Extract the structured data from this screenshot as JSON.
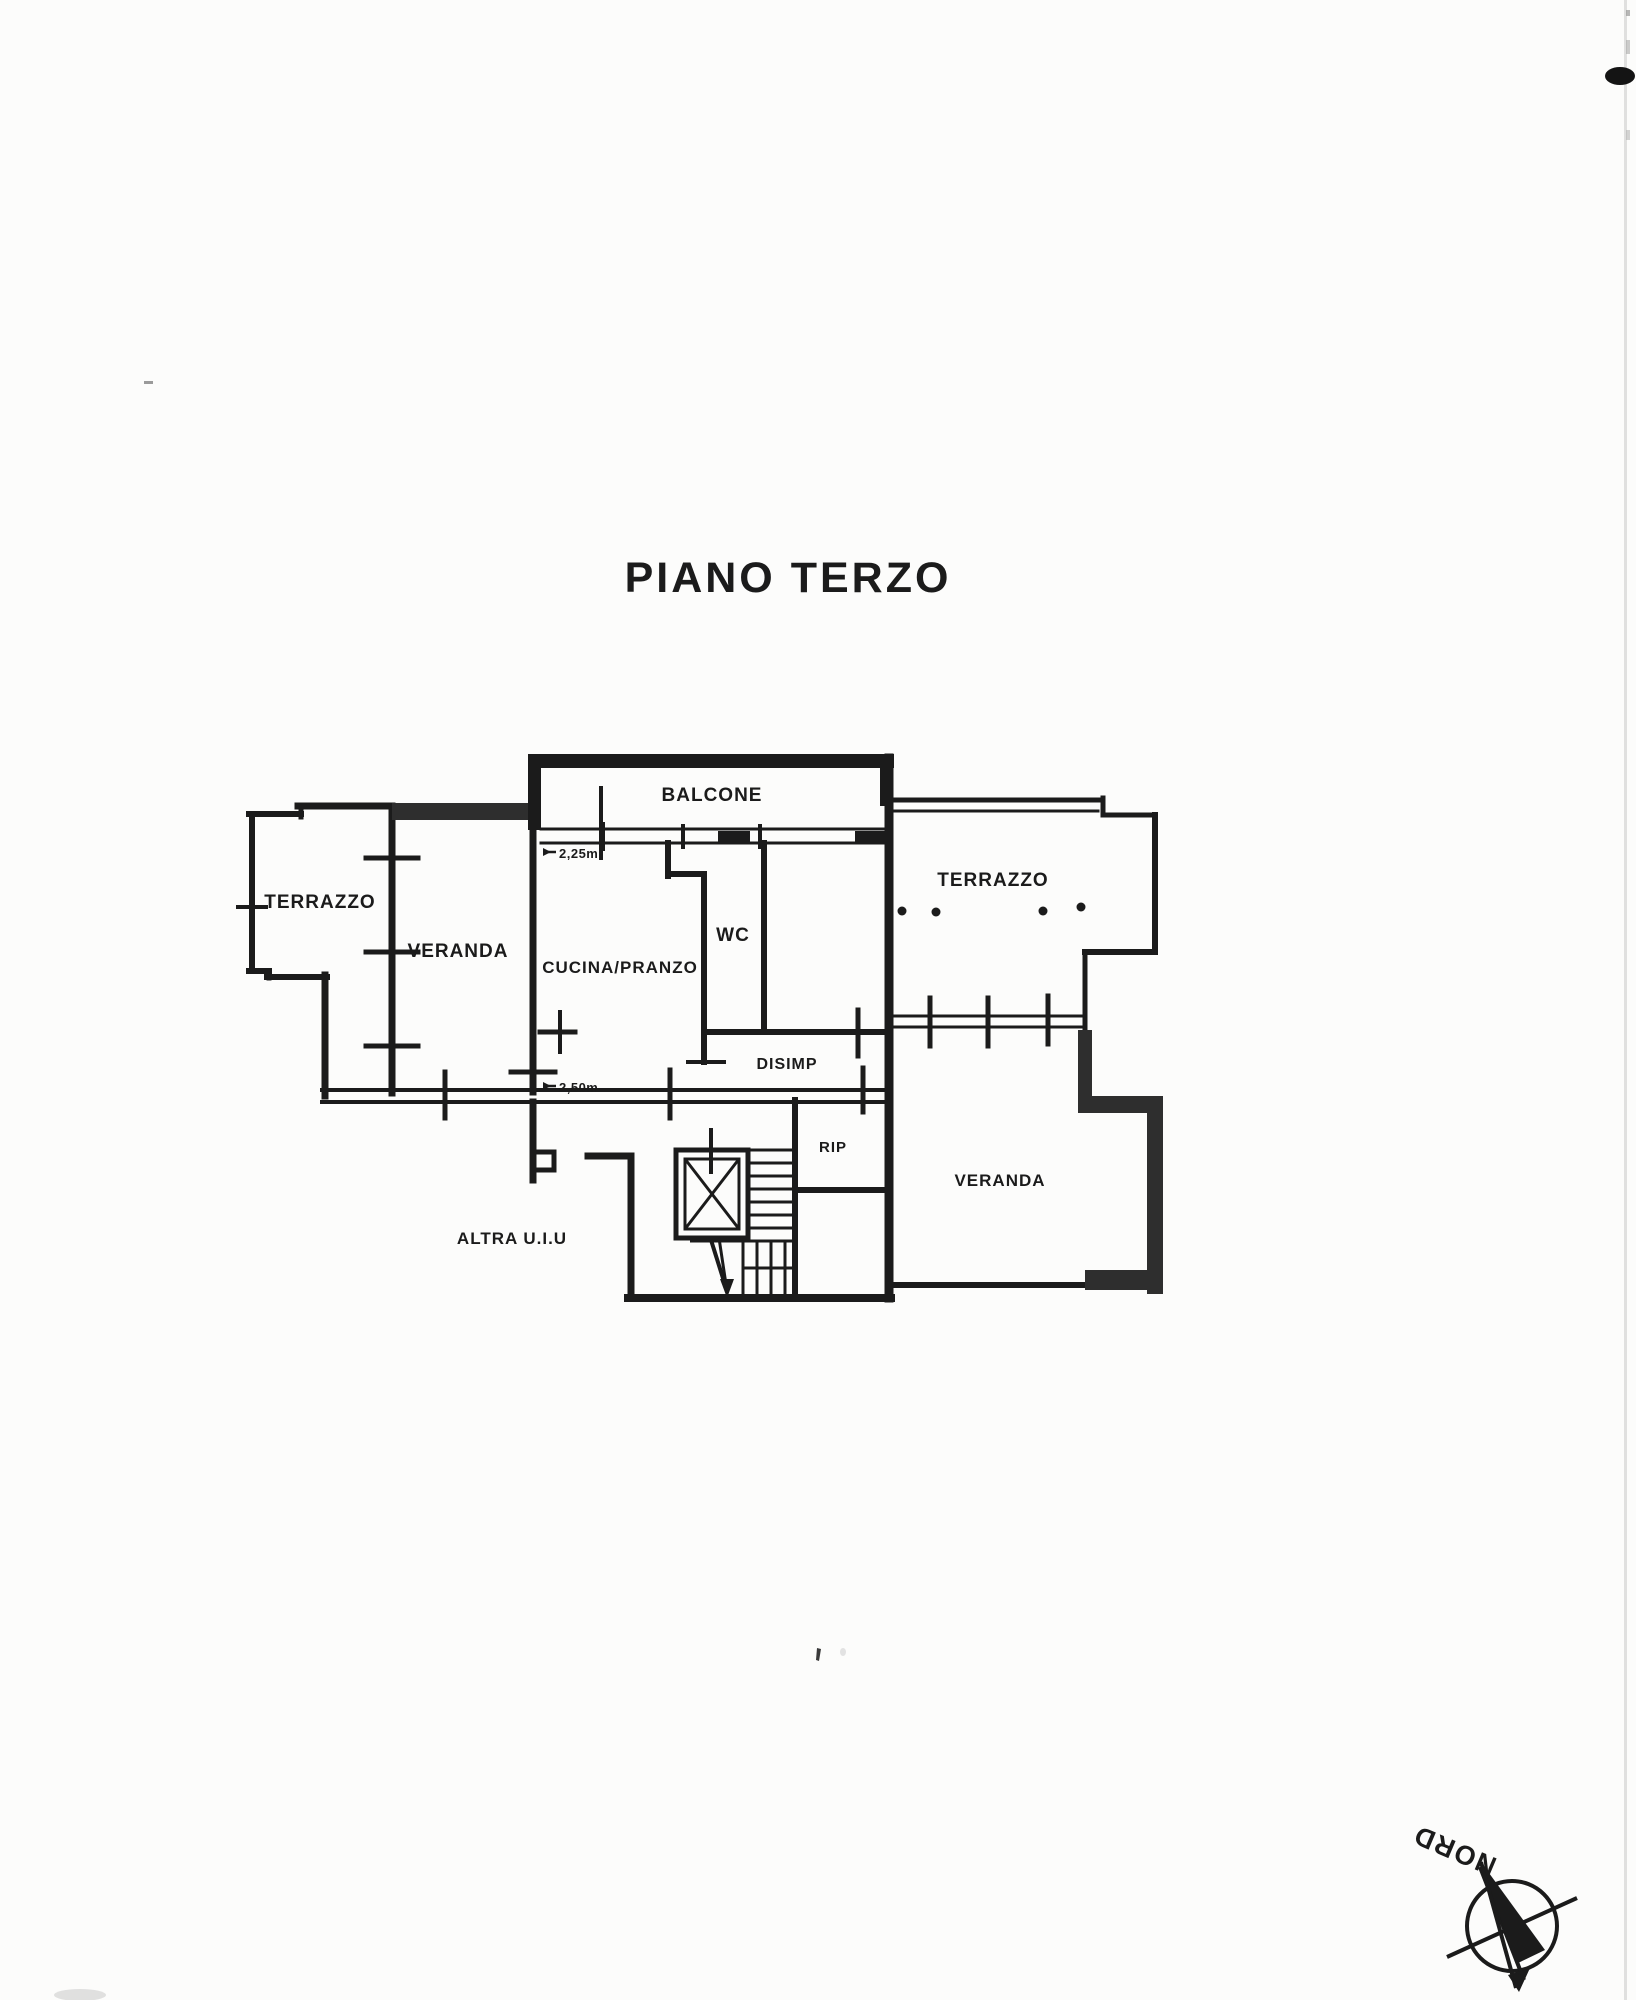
{
  "page": {
    "title": "PIANO TERZO"
  },
  "rooms": {
    "balcone": "BALCONE",
    "terrazzo_left": "TERRAZZO",
    "veranda_left": "VERANDA",
    "cucina": "CUCINA/PRANZO",
    "wc": "WC",
    "terrazzo_right": "TERRAZZO",
    "disimp": "DISIMP",
    "rip": "RIP",
    "veranda_right": "VERANDA",
    "altra_uiu": "ALTRA U.I.U"
  },
  "annotations": {
    "height_upper": "2,25m",
    "height_lower": "2,50m"
  },
  "compass": {
    "label": "NORD"
  },
  "colors": {
    "ink": "#1b1b1b",
    "thick_wall": "#2e2e2e",
    "paper": "#fcfcfb"
  }
}
